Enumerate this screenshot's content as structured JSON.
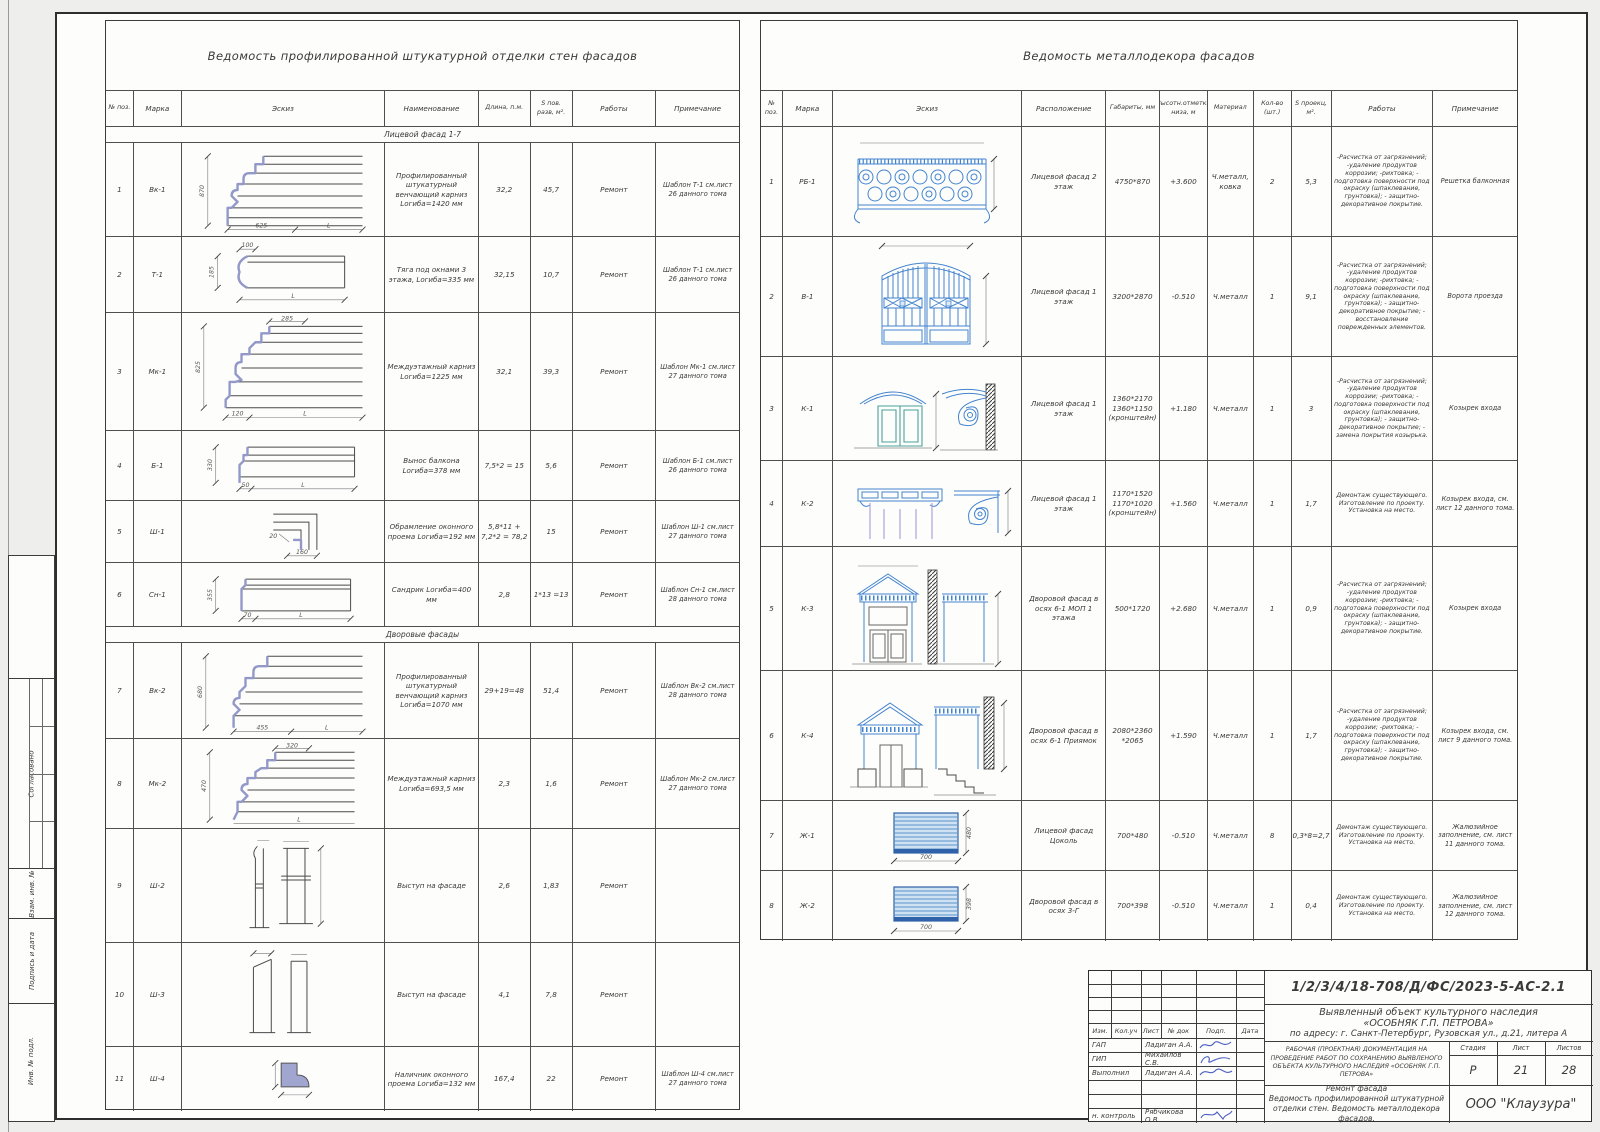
{
  "sheet": {
    "side_labels": {
      "approved": "Согласовано",
      "replace_inv": "Взам. инв. №",
      "sign_date": "Подпись и дата",
      "inv_orig": "Инв. № подл."
    }
  },
  "plaster_table": {
    "title": "Ведомость профилированной штукатурной отделки стен фасадов",
    "columns": {
      "num": "№ поз.",
      "mark": "Марка",
      "sketch": "Эскиз",
      "name": "Наименование",
      "length": "Длина, п.м.",
      "area": "S пов. разв, м².",
      "works": "Работы",
      "note": "Примечание"
    },
    "section1": "Лицевой фасад 1-7",
    "section2": "Дворовые фасады",
    "rows": [
      {
        "num": "1",
        "mark": "Вк-1",
        "name": "Профилированный штукатурный венчающий карниз  Lогиба=1420 мм",
        "length": "32,2",
        "area": "45,7",
        "works": "Ремонт",
        "note": "Шаблон Т-1 см.лист 26 данного тома",
        "dims": [
          "870",
          "625",
          "L"
        ]
      },
      {
        "num": "2",
        "mark": "Т-1",
        "name": "Тяга под окнами 3 этажа, Lогиба=335 мм",
        "length": "32,15",
        "area": "10,7",
        "works": "Ремонт",
        "note": "Шаблон Т-1 см.лист 26 данного тома",
        "dims": [
          "100",
          "185",
          "L"
        ]
      },
      {
        "num": "3",
        "mark": "Мк-1",
        "name": "Междуэтажный карниз Lогиба=1225 мм",
        "length": "32,1",
        "area": "39,3",
        "works": "Ремонт",
        "note": "Шаблон Мк-1 см.лист 27 данного тома",
        "dims": [
          "285",
          "825",
          "120",
          "L"
        ]
      },
      {
        "num": "4",
        "mark": "Б-1",
        "name": "Вынос балкона Lогиба=378 мм",
        "length": "7,5*2 = 15",
        "area": "5,6",
        "works": "Ремонт",
        "note": "Шаблон Б-1 см.лист 26 данного тома",
        "dims": [
          "330",
          "50",
          "L"
        ]
      },
      {
        "num": "5",
        "mark": "Ш-1",
        "name": "Обрамление оконного проема  Lогиба=192 мм",
        "length": "5,8*11 + 7,2*2 = 78,2",
        "area": "15",
        "works": "Ремонт",
        "note": "Шаблон Ш-1 см.лист 27 данного тома",
        "dims": [
          "20",
          "160"
        ]
      },
      {
        "num": "6",
        "mark": "Сн-1",
        "name": "Сандрик  Lогиба=400 мм",
        "length": "2,8",
        "area": "1*13 =13",
        "works": "Ремонт",
        "note": "Шаблон Сн-1 см.лист 28 данного тома",
        "dims": [
          "355",
          "70",
          "L"
        ]
      },
      {
        "num": "7",
        "mark": "Вк-2",
        "name": "Профилированный штукатурный венчающий карниз  Lогиба=1070 мм",
        "length": "29+19=48",
        "area": "51,4",
        "works": "Ремонт",
        "note": "Шаблон Вк-2 см.лист 28 данного тома",
        "dims": [
          "680",
          "455",
          "L"
        ]
      },
      {
        "num": "8",
        "mark": "Мк-2",
        "name": "Междуэтажный карниз Lогиба=693,5 мм",
        "length": "2,3",
        "area": "1,6",
        "works": "Ремонт",
        "note": "Шаблон Мк-2 см.лист 27 данного тома",
        "dims": [
          "320",
          "470",
          "L"
        ]
      },
      {
        "num": "9",
        "mark": "Ш-2",
        "name": "Выступ на фасаде",
        "length": "2,6",
        "area": "1,83",
        "works": "Ремонт",
        "note": "",
        "dims": []
      },
      {
        "num": "10",
        "mark": "Ш-3",
        "name": "Выступ на фасаде",
        "length": "4,1",
        "area": "7,8",
        "works": "Ремонт",
        "note": "",
        "dims": []
      },
      {
        "num": "11",
        "mark": "Ш-4",
        "name": "Наличник оконного проема Lогиба=132 мм",
        "length": "167,4",
        "area": "22",
        "works": "Ремонт",
        "note": "Шаблон Ш-4 см.лист 27 данного тома",
        "dims": []
      }
    ]
  },
  "metal_table": {
    "title": "Ведомость металлодекора фасадов",
    "columns": {
      "num": "№ поз.",
      "mark": "Марка",
      "sketch": "Эскиз",
      "location": "Расположение",
      "size": "Габариты, мм",
      "elev": "Высотн.отметка низа, м",
      "material": "Материал",
      "qty": "Кол-во (шт.)",
      "area": "S проекц, м².",
      "works": "Работы",
      "note": "Примечание"
    },
    "rows": [
      {
        "num": "1",
        "mark": "РБ-1",
        "location": "Лицевой фасад 2 этаж",
        "size": "4750*870",
        "elev": "+3.600",
        "material": "Ч.металл, ковка",
        "qty": "2",
        "area": "5,3",
        "works": "-Расчистка от загрязнений; -удаление продуктов коррозии; -рихтовка; - подготовка поверхности под окраску (шпаклевание, грунтовка); - защитно-декоративное покрытие.",
        "note": "Решетка балконная",
        "dims": []
      },
      {
        "num": "2",
        "mark": "В-1",
        "location": "Лицевой фасад 1 этаж",
        "size": "3200*2870",
        "elev": "-0.510",
        "material": "Ч.металл",
        "qty": "1",
        "area": "9,1",
        "works": "-Расчистка от загрязнений; -удаление продуктов коррозии; -рихтовка; - подготовка поверхности под окраску (шпаклевание, грунтовка); - защитно-декоративное покрытие; - восстановление поврежденных элементов.",
        "note": "Ворота проезда",
        "dims": []
      },
      {
        "num": "3",
        "mark": "К-1",
        "location": "Лицевой фасад 1 этаж",
        "size": "1360*2170 1360*1150 (кронштейн)",
        "elev": "+1.180",
        "material": "Ч.металл",
        "qty": "1",
        "area": "3",
        "works": "-Расчистка от загрязнений; -удаление продуктов коррозии; -рихтовка; - подготовка поверхности под окраску (шпаклевание, грунтовка); - защитно-декоративное покрытие; - замена покрытия козырька.",
        "note": "Козырек входа",
        "dims": []
      },
      {
        "num": "4",
        "mark": "К-2",
        "location": "Лицевой фасад 1 этаж",
        "size": "1170*1520 1170*1020 (кронштейн)",
        "elev": "+1.560",
        "material": "Ч.металл",
        "qty": "1",
        "area": "1,7",
        "works": "Демонтаж существующего. Изготовление по проекту. Установка на место.",
        "note": "Козырек входа, см. лист 12 данного тома.",
        "dims": []
      },
      {
        "num": "5",
        "mark": "К-3",
        "location": "Дворовой фасад в осях 6-1 МОП 1 этажа",
        "size": "500*1720",
        "elev": "+2.680",
        "material": "Ч.металл",
        "qty": "1",
        "area": "0,9",
        "works": "-Расчистка от загрязнений; -удаление продуктов коррозии; -рихтовка; - подготовка поверхности под окраску (шпаклевание, грунтовка); - защитно-декоративное покрытие.",
        "note": "Козырек входа",
        "dims": []
      },
      {
        "num": "6",
        "mark": "К-4",
        "location": "Дворовой фасад в осях 6-1 Приямок",
        "size": "2080*2360 *2065",
        "elev": "+1.590",
        "material": "Ч.металл",
        "qty": "1",
        "area": "1,7",
        "works": "-Расчистка от загрязнений; -удаление продуктов коррозии; -рихтовка; - подготовка поверхности под окраску (шпаклевание, грунтовка); - защитно-декоративное покрытие.",
        "note": "Козырек входа, см. лист 9 данного тома.",
        "dims": []
      },
      {
        "num": "7",
        "mark": "Ж-1",
        "location": "Лицевой фасад Цоколь",
        "size": "700*480",
        "elev": "-0.510",
        "material": "Ч.металл",
        "qty": "8",
        "area": "0,3*8=2,7",
        "works": "Демонтаж существующего. Изготовление по проекту. Установка на место.",
        "note": "Жалюзийное заполнение, см. лист 11 данного тома.",
        "dims": [
          "700",
          "480"
        ]
      },
      {
        "num": "8",
        "mark": "Ж-2",
        "location": "Дворовой фасад в осях 3-Г",
        "size": "700*398",
        "elev": "-0.510",
        "material": "Ч.металл",
        "qty": "1",
        "area": "0,4",
        "works": "Демонтаж существующего. Изготовление по проекту. Установка на место.",
        "note": "Жалюзийное заполнение, см. лист 12 данного тома.",
        "dims": [
          "700",
          "398"
        ]
      }
    ]
  },
  "title_block": {
    "doc_number": "1/2/3/4/18-708/Д/ФС/2023-5-АС-2.1",
    "object_line1": "Выявленный объект культурного наследия",
    "object_line2": "«ОСОБНЯК Г.П. ПЕТРОВА»",
    "address": "по адресу: г. Санкт-Петербург, Рузовская ул., д.21, литера А",
    "project": "РАБОЧАЯ (ПРОЕКТНАЯ) ДОКУМЕНТАЦИЯ НА ПРОВЕДЕНИЕ РАБОТ ПО СОХРАНЕНИЮ ВЫЯВЛЕНОГО ОБЪЕКТА КУЛЬТУРНОГО НАСЛЕДИЯ «ОСОБНЯК Г.П. ПЕТРОВА»",
    "sheet_title_1": "Ремонт фасада",
    "sheet_title_2": "Ведомость профилированной штукатурной отделки стен. Ведомость металлодекора фасадов.",
    "header_cols": [
      "Изм.",
      "Кол.уч",
      "Лист",
      "№ док",
      "Подп.",
      "Дата"
    ],
    "roles": [
      {
        "role": "ГАП",
        "name": "Ладиган А.А."
      },
      {
        "role": "ГИП",
        "name": "Михайлов С.В."
      },
      {
        "role": "Выполнил",
        "name": "Ладиган А.А."
      },
      {
        "role": "н. контроль",
        "name": "Рябчикова О.В."
      }
    ],
    "stage_label": "Стадия",
    "sheet_label": "Лист",
    "sheets_label": "Листов",
    "stage": "Р",
    "sheet_num": "21",
    "sheets_total": "28",
    "company": "ООО \"Клаузура\""
  }
}
